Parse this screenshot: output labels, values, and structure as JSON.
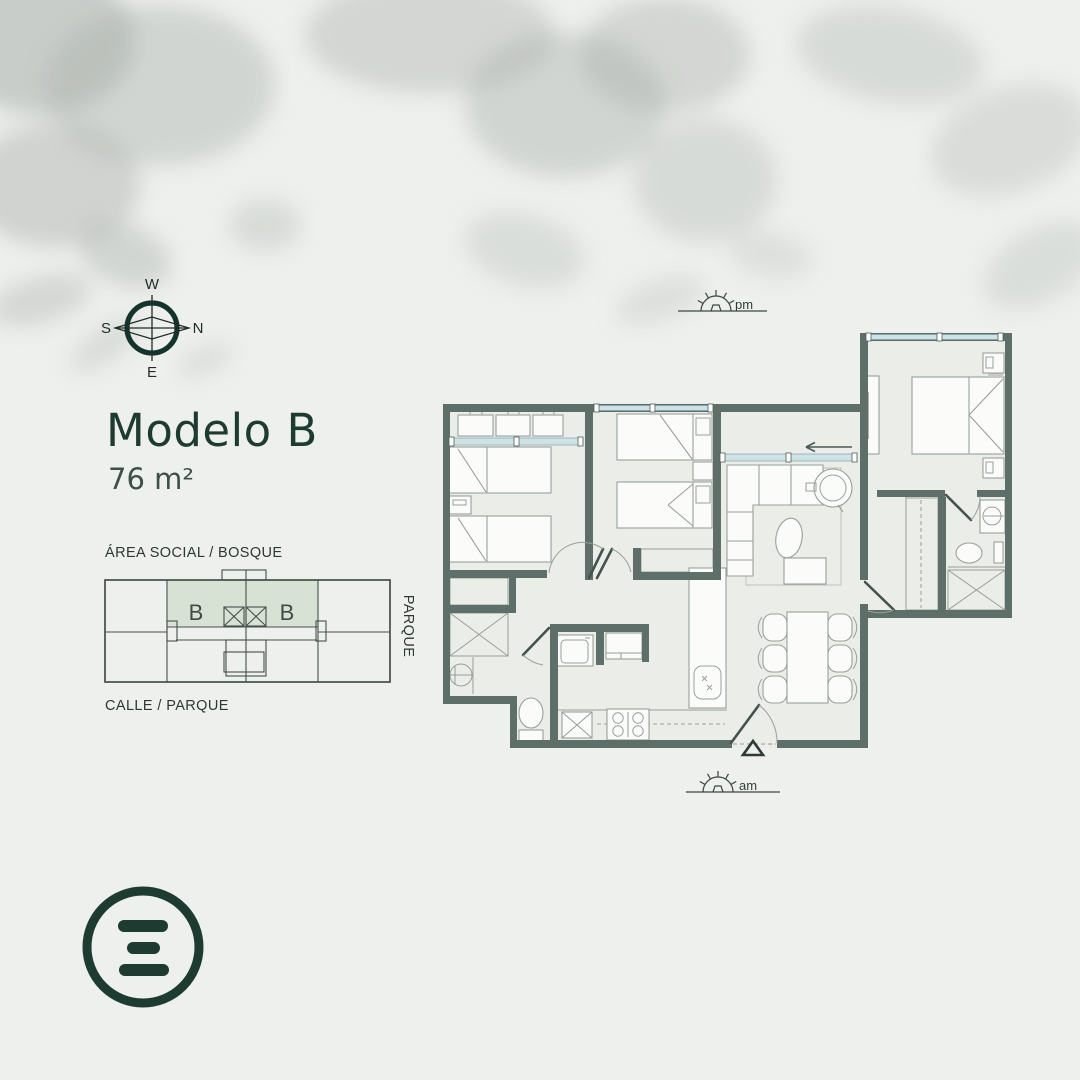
{
  "title": {
    "model": "Modelo B",
    "area": "76 m²"
  },
  "compass": {
    "west": "W",
    "south": "S",
    "north": "N",
    "east": "E"
  },
  "suns": {
    "pm": "pm",
    "am": "am"
  },
  "key_plan": {
    "top_label": "ÁREA SOCIAL / BOSQUE",
    "bottom_label": "CALLE / PARQUE",
    "side_label": "PARQUE",
    "unit_left_label": "B",
    "unit_right_label": "B"
  },
  "colors": {
    "bg": "#eef0ed",
    "wall": "#5e6f6a",
    "floor": "#ebede8",
    "glazing": "#cfe3e7",
    "accent": "#1d3b31",
    "label": "#2e3733",
    "line": "#98a09a",
    "door": "#44534d",
    "highlight": "#d8e2d4",
    "shadow": "#aab0ab"
  }
}
